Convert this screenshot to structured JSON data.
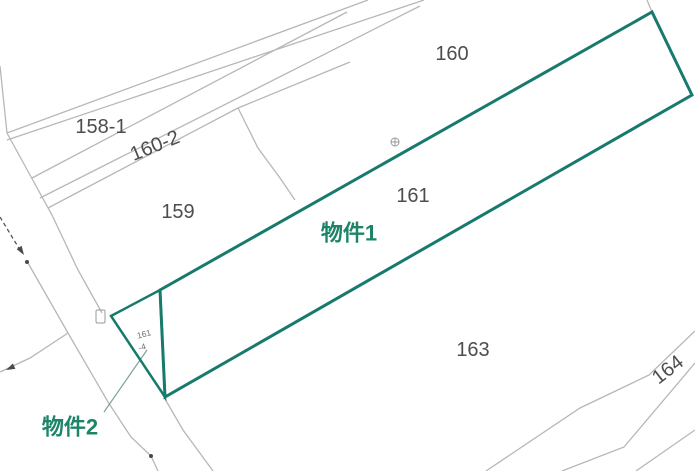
{
  "map": {
    "width": 695,
    "height": 471,
    "background": "#ffffff",
    "colors": {
      "boundary_gray": "#b7b7b7",
      "survey_dark": "#4a4a4a",
      "symbol_gray": "#9a9a9a",
      "label_ink": "#4d4d4d",
      "highlight_teal": "#177a6c",
      "highlight_text": "#1d8468",
      "leader_green": "#7aa296"
    },
    "gray_lines": [
      {
        "name": "boundary-road-top-stub",
        "points": "0,66 7,133"
      },
      {
        "name": "boundary-upper-strip-1",
        "points": "7,133 368,0"
      },
      {
        "name": "boundary-upper-strip-2",
        "points": "7,140 424,0"
      },
      {
        "name": "boundary-158-160-2",
        "points": "32,178 347,12"
      },
      {
        "name": "boundary-160-2-lower",
        "points": "40,198 420,6"
      },
      {
        "name": "boundary-159-top",
        "points": "48,208 238,108 350,62"
      },
      {
        "name": "boundary-159-160-divider",
        "points": "238,108 258,148 280,178 295,200"
      },
      {
        "name": "boundary-road-right-edge",
        "points": "7,133 30,175 52,215 78,270 102,313"
      },
      {
        "name": "boundary-road-left-edge",
        "points": "28,263 68,333 108,402 131,437 151,456 158,471"
      },
      {
        "name": "boundary-branch-southwest",
        "points": "68,333 30,358 0,372"
      },
      {
        "name": "boundary-below-triangle",
        "points": "165,399 183,430 213,471"
      },
      {
        "name": "boundary-160-right-stub",
        "points": "647,0 652,12"
      },
      {
        "name": "boundary-163-164",
        "points": "695,331 649,375 580,408 486,471"
      },
      {
        "name": "boundary-164-lower",
        "points": "695,363 624,447 562,471"
      },
      {
        "name": "boundary-corner-southeast",
        "points": "695,430 636,471"
      }
    ],
    "survey_line": {
      "name": "survey-arrow-line",
      "points": "0,217 20,250",
      "dash": "4 3"
    },
    "arrowheads": [
      {
        "name": "survey-arrowhead",
        "points": "24,255 16.6,249.1 21.6,245.8"
      },
      {
        "name": "branch-arrowhead",
        "points": "6,370 15.4,368.9 12.9,363.5"
      }
    ],
    "dots": [
      {
        "name": "survey-dot-upper",
        "cx": 27,
        "cy": 262,
        "r": 2
      },
      {
        "name": "survey-dot-lower",
        "cx": 151,
        "cy": 456,
        "r": 2
      }
    ],
    "symbols": {
      "corner_square": {
        "name": "boundary-marker-square",
        "x": 96,
        "y": 310,
        "w": 9,
        "h": 13
      },
      "circle_cross": {
        "name": "boundary-marker-circle-cross",
        "cx": 395,
        "cy": 142,
        "r": 4
      }
    },
    "highlight_parcels": [
      {
        "name": "property1-outline",
        "points": "160,290 652,12 692,95 165,397",
        "stroke_width": 3
      },
      {
        "name": "property2-outline",
        "points": "111,316 160,290 165,397",
        "stroke_width": 2.5
      }
    ],
    "leader": {
      "name": "property2-leader-line",
      "points": "104,412 147,350"
    },
    "labels": [
      {
        "name": "parcel-label-158-1",
        "text": "158-1",
        "x": 101,
        "y": 127,
        "rot": 0,
        "size": 20,
        "cls": "parcel-num"
      },
      {
        "name": "parcel-label-160-2",
        "text": "160-2",
        "x": 155,
        "y": 146,
        "rot": -22,
        "size": 20,
        "cls": "parcel-num"
      },
      {
        "name": "parcel-label-159",
        "text": "159",
        "x": 178,
        "y": 212,
        "rot": 0,
        "size": 20,
        "cls": "parcel-num"
      },
      {
        "name": "parcel-label-160",
        "text": "160",
        "x": 452,
        "y": 54,
        "rot": 0,
        "size": 20,
        "cls": "parcel-num"
      },
      {
        "name": "parcel-label-161",
        "text": "161",
        "x": 413,
        "y": 196,
        "rot": 0,
        "size": 20,
        "cls": "parcel-num"
      },
      {
        "name": "parcel-label-163",
        "text": "163",
        "x": 473,
        "y": 350,
        "rot": 0,
        "size": 20,
        "cls": "parcel-num"
      },
      {
        "name": "parcel-label-164",
        "text": "164",
        "x": 668,
        "y": 370,
        "rot": -38,
        "size": 20,
        "cls": "parcel-num"
      },
      {
        "name": "parcel-label-161-4a",
        "text": "161",
        "x": 144,
        "y": 334,
        "rot": -15,
        "size": 8.5,
        "cls": "tiny-num"
      },
      {
        "name": "parcel-label-161-4b",
        "text": "-4",
        "x": 142,
        "y": 347,
        "rot": -15,
        "size": 8.5,
        "cls": "tiny-num"
      },
      {
        "name": "property1-label",
        "text": "物件1",
        "x": 349,
        "y": 233,
        "rot": 0,
        "size": 22,
        "cls": "prop-label"
      },
      {
        "name": "property2-label",
        "text": "物件2",
        "x": 70,
        "y": 427,
        "rot": 0,
        "size": 22,
        "cls": "prop-label"
      }
    ]
  }
}
